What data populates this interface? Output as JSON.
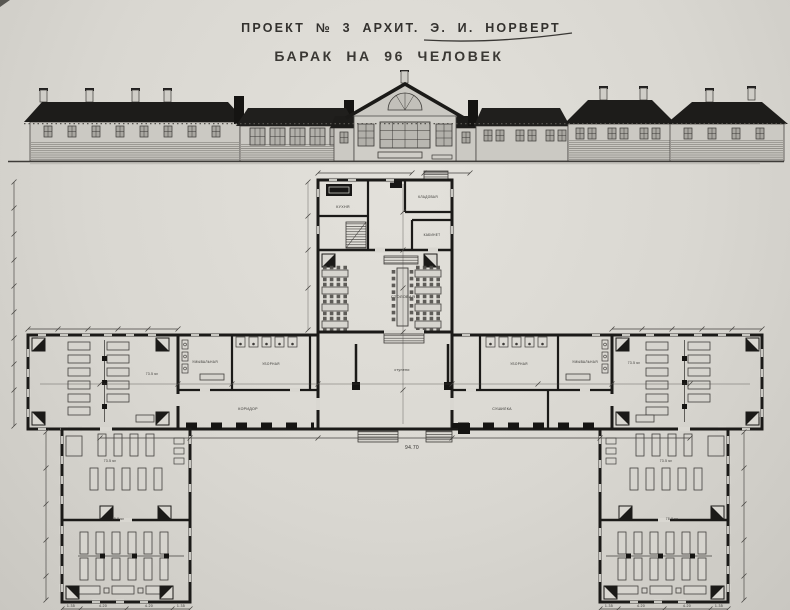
{
  "title": {
    "line1": "ПРОЕКТ № 3 АРХИТ. Э. И. НОРВЕРТ",
    "line2": "БАРАК НА 96 ЧЕЛОВЕК"
  },
  "plan": {
    "rooms": {
      "dining_hall": "СТОЛОВАЯ",
      "kitchen": "КУХНЯ",
      "pantry": "КЛАДОВАЯ",
      "office": "КАБИНЕТ",
      "washroom_left": "УМЫВАЛЬНАЯ",
      "toilet_left": "УБОРНАЯ",
      "toilet_right": "УБОРНАЯ",
      "washroom_right": "УМЫВАЛЬНАЯ",
      "drying_room": "СУШИЛКА",
      "corridor": "КОРИДОР",
      "entry_steps": "ступени"
    },
    "areas": {
      "dorm_left": "73.5 м²",
      "dorm_right": "73.5 м²",
      "wing_left_upper": "73.5 м²",
      "wing_left_lower": "78.0 м²",
      "wing_right_upper": "73.5 м²",
      "wing_right_lower": "78.0 м²"
    },
    "dimensions": {
      "overall": "94.70",
      "wing_segments": [
        "1.35",
        "4.20",
        "4.20",
        "1.35"
      ]
    }
  },
  "colors": {
    "paper": "#d9d7d1",
    "ink": "#1b1a18"
  }
}
